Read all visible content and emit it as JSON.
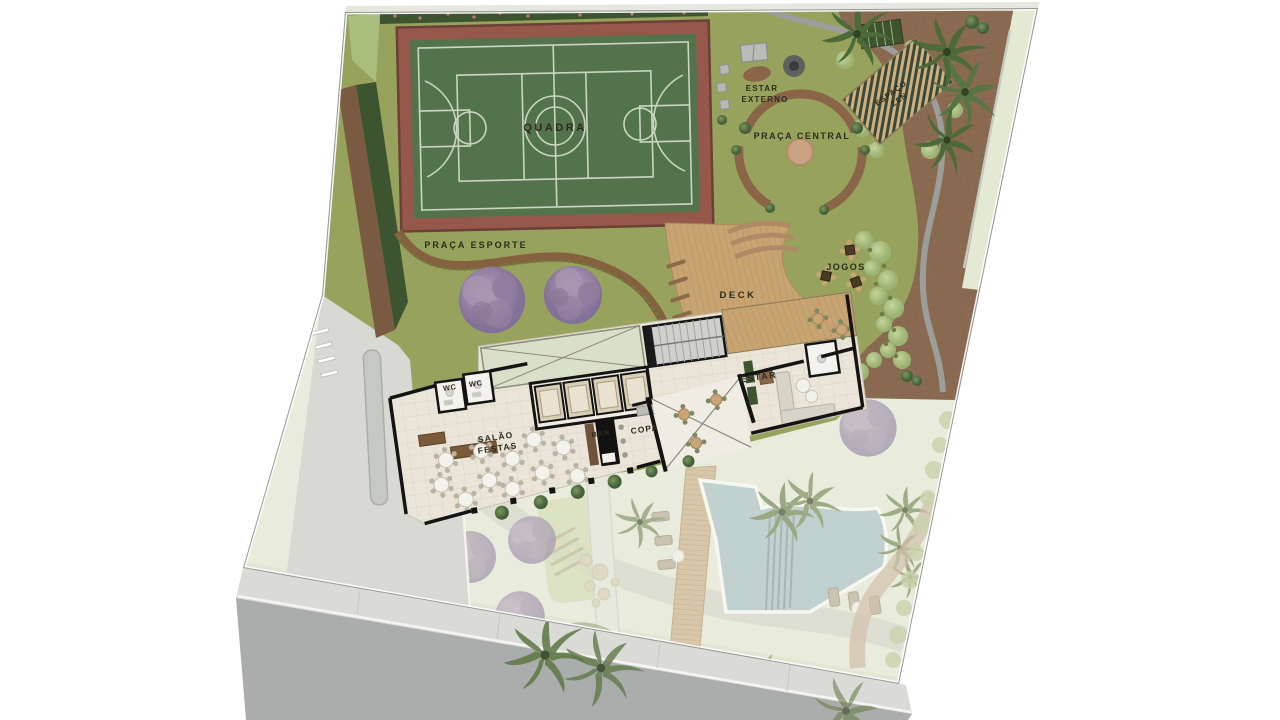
{
  "plan": {
    "title": "Implantação / site plan of leisure rooftop",
    "labels": {
      "quadra": "QUADRA",
      "estar_externo_line1": "ESTAR",
      "estar_externo_line2": "EXTERNO",
      "praca_central": "PRAÇA CENTRAL",
      "espaco_zen_line1": "ESPAÇO",
      "espaco_zen_line2": "ZEN",
      "praca_esporte": "PRAÇA ESPORTE",
      "jogos": "JOGOS",
      "deck": "DECK",
      "estar": "ESTAR",
      "wc_left": "WC",
      "wc_right": "WC",
      "salao_line1": "SALÃO",
      "salao_line2": "FESTAS",
      "bar": "BAR",
      "copa": "COPA"
    },
    "colors": {
      "grass": "#97a35d",
      "court": "#52734c",
      "court_lines": "#cbd5c0",
      "track": "#95584a",
      "terrace_pavers": "#8a6b51",
      "deck_wood": "#c8a473",
      "hedge": "#3c5430",
      "dirt": "#7a5a40",
      "street": "#abadac",
      "sidewalk": "#dadbd7",
      "pool": "#a9c2c8",
      "building_floor": "#eae5d8",
      "wall": "#141414",
      "purple_tree": "#9c87a5",
      "palm": "#4d6a39",
      "path_brown": "#85613f",
      "label_text": "#2e2b1e",
      "faded_base": "#e9ecdc"
    }
  }
}
